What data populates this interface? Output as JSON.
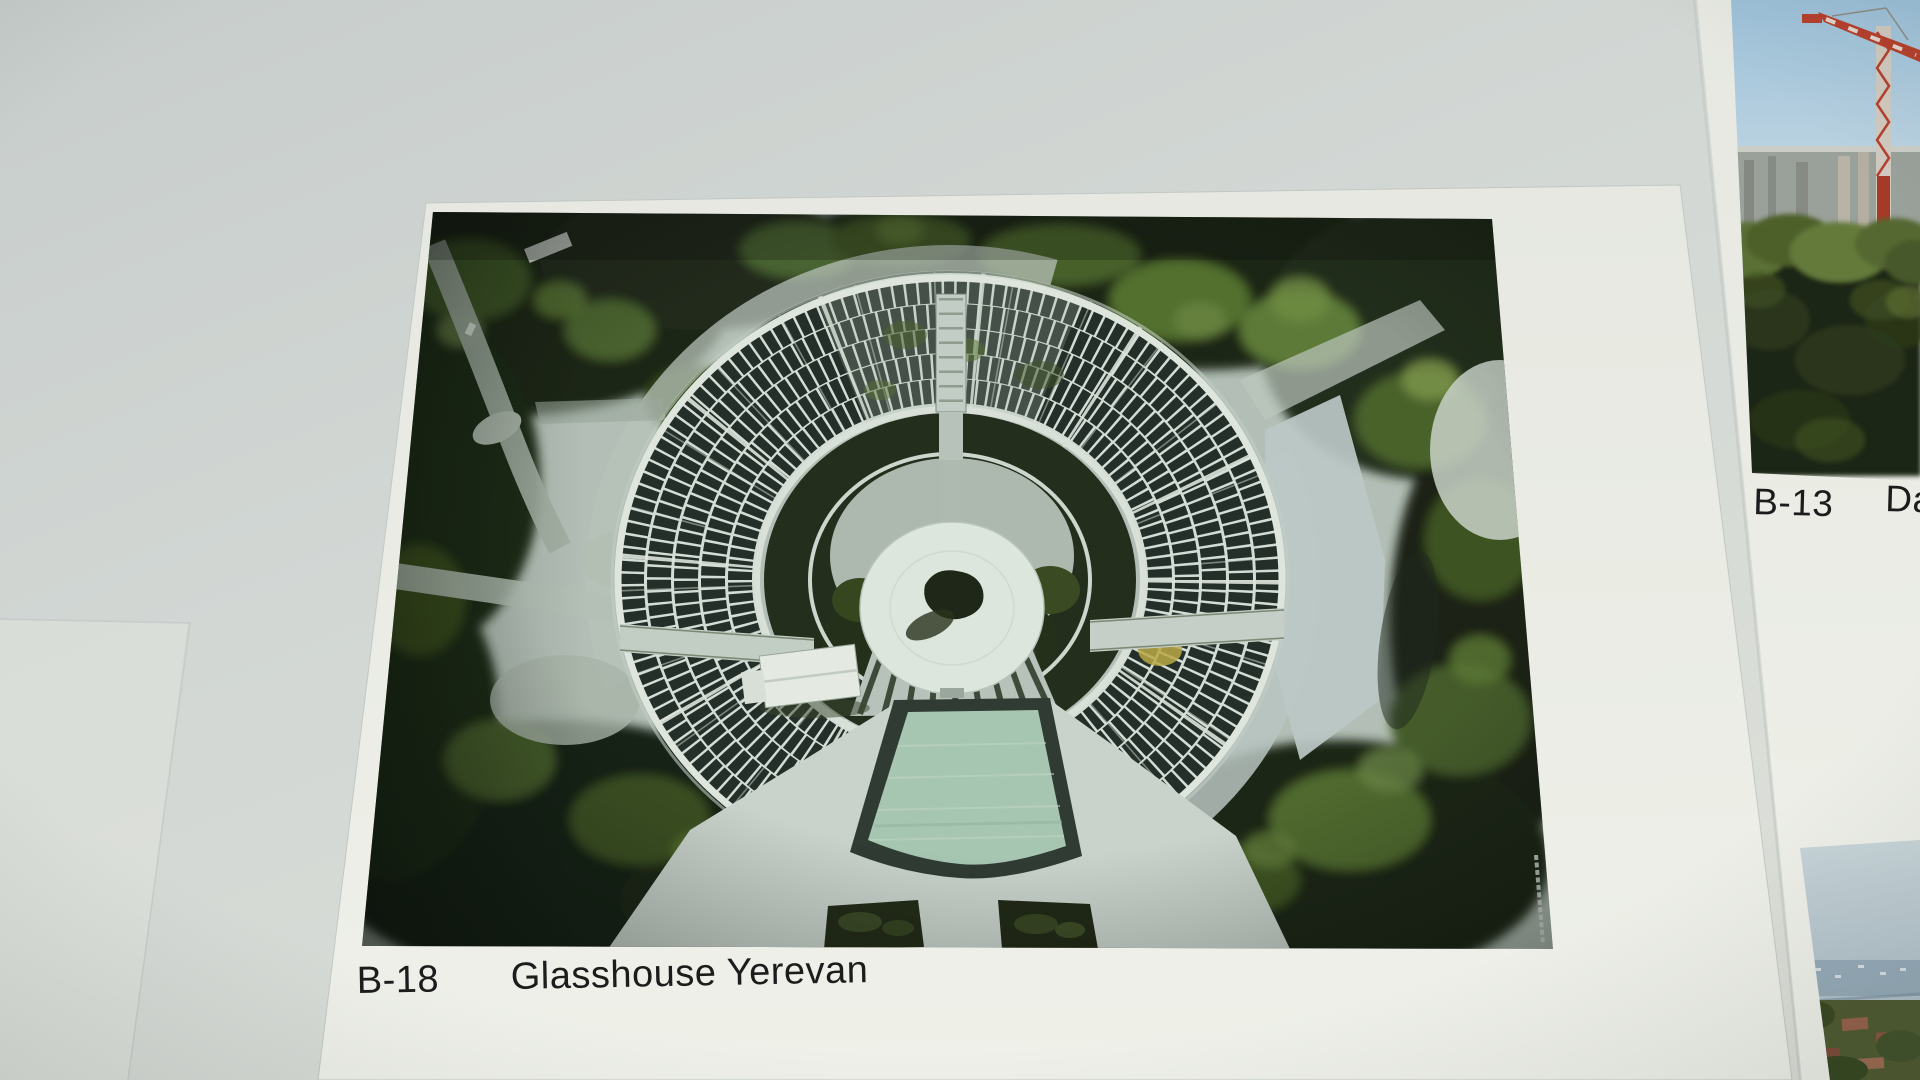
{
  "posters": {
    "main": {
      "code": "B-18",
      "title": "Glasshouse Yerevan"
    },
    "right": {
      "code": "B-13",
      "title_visible": "Da"
    }
  },
  "colors": {
    "wall": "#ced3d1",
    "poster_paper": "#e9ebe4",
    "caption_text": "#1c1c1c",
    "glass_dark": "#17211c",
    "mullion_white": "#d6ded6",
    "pool_water": "#a7c6b2",
    "foliage_dark": "#1c2617",
    "foliage_light": "#6f8c42",
    "concrete_pale": "#c3cdc6",
    "crane_red": "#b5402d",
    "sky_blue": "#9cc0d8"
  }
}
